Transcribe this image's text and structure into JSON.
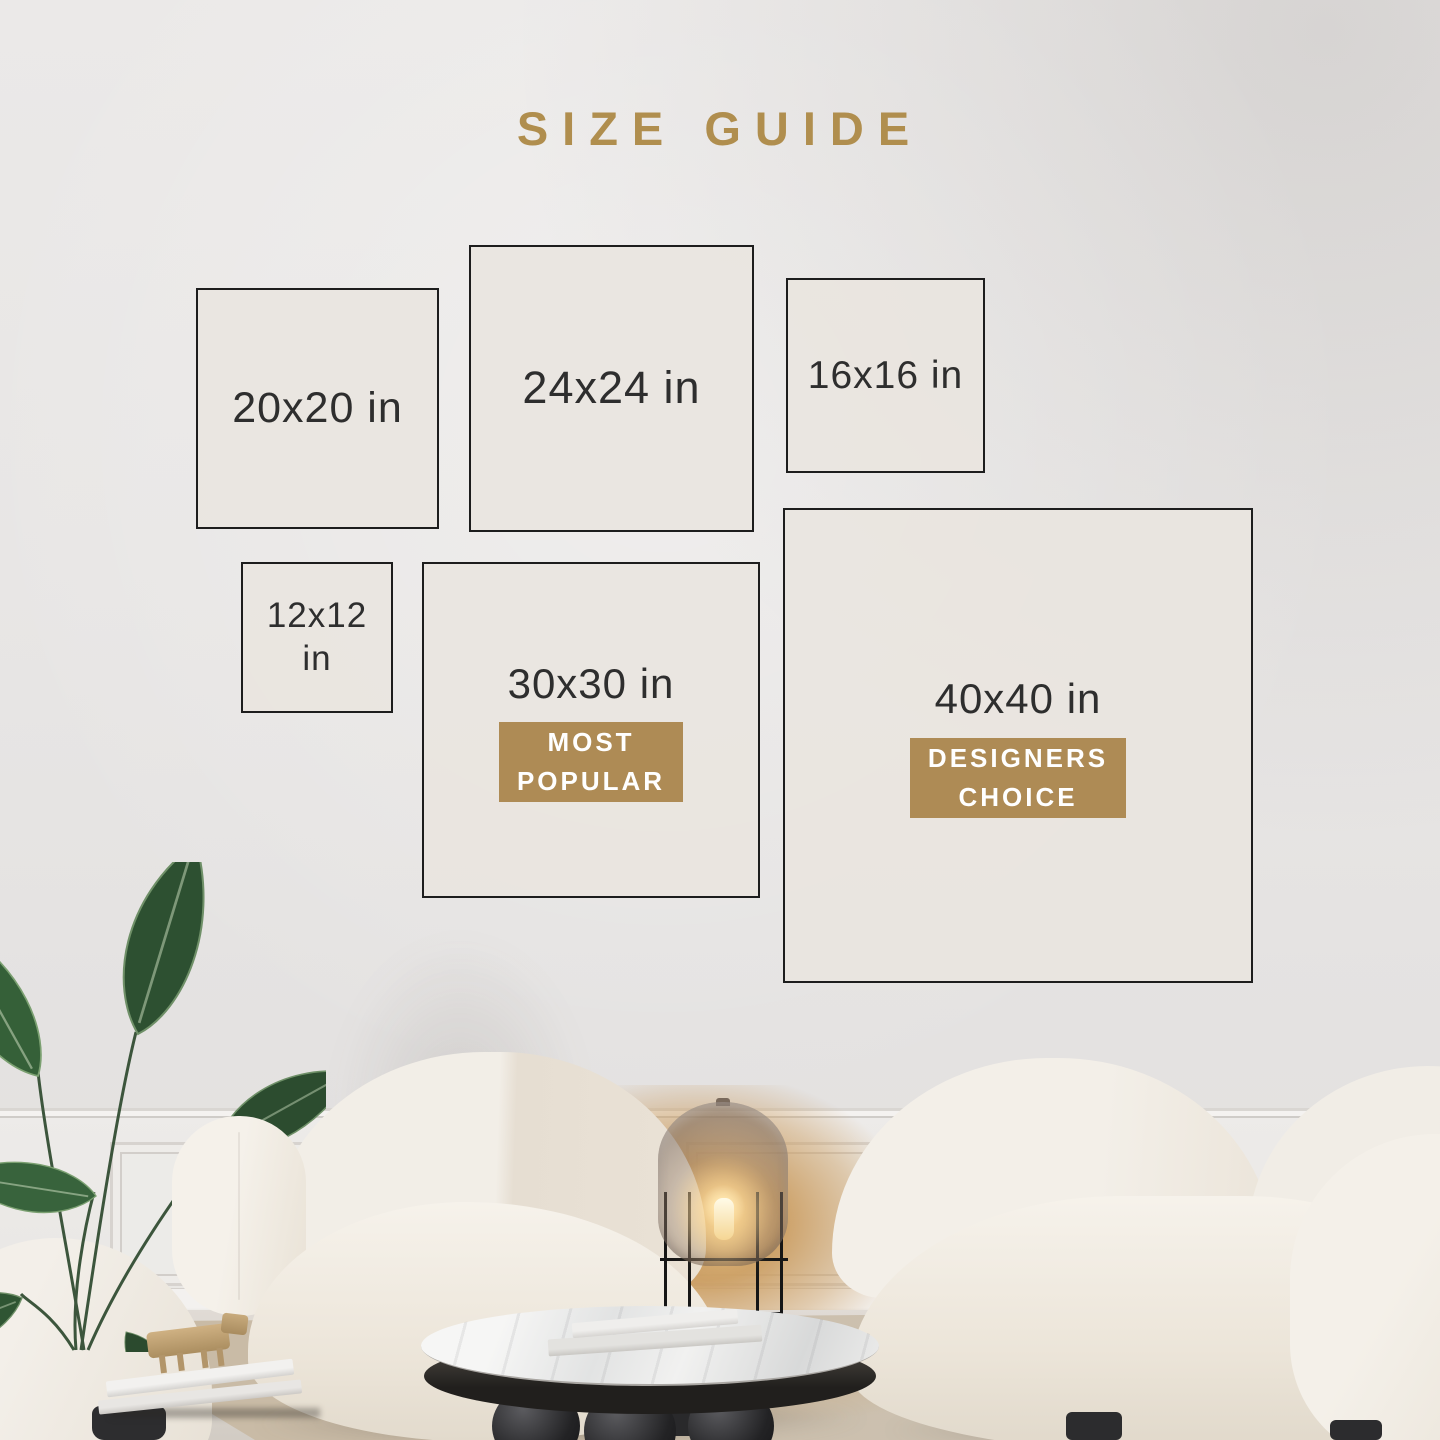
{
  "title": "SIZE GUIDE",
  "boxes": [
    {
      "id": "20x20",
      "label": "20x20 in"
    },
    {
      "id": "24x24",
      "label": "24x24 in"
    },
    {
      "id": "16x16",
      "label": "16x16 in"
    },
    {
      "id": "12x12",
      "label": "12x12\nin"
    },
    {
      "id": "30x30",
      "label": "30x30 in",
      "badge": "MOST\nPOPULAR"
    },
    {
      "id": "40x40",
      "label": "40x40 in",
      "badge": "DESIGNERS\nCHOICE"
    }
  ],
  "colors": {
    "accent_gold": "#b08e4e",
    "badge_gold": "#ae8b55",
    "badge_text": "#ffffff",
    "box_border": "#1d1d1d",
    "box_fill": "#e9e5df",
    "label_text": "#2e2e2e",
    "wall": "#e8e6e5"
  }
}
